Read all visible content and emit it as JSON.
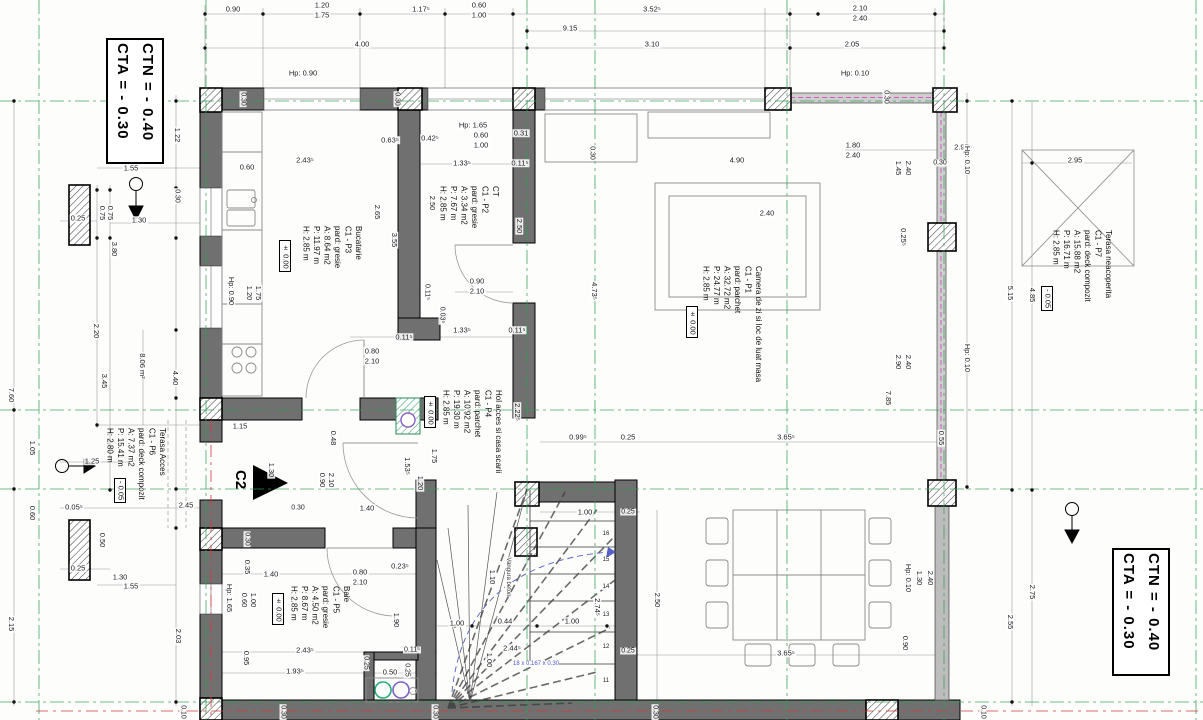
{
  "drawing": {
    "elevation_boxes": {
      "top_left": [
        "CTA = - 0.30",
        "CTN = - 0.40"
      ],
      "bottom_right": [
        "CTA = - 0.30",
        "CTN = - 0.40"
      ]
    },
    "section_marker": "C2",
    "stair_formula": "18 x 0.167 x 0.30",
    "stair_stringer_note": "Vangura beton",
    "colors": {
      "axis_green": "#2e9e52",
      "axis_red": "#d33a3a",
      "parapet_magenta": "#d957c8",
      "stair_blue": "#4a52c4",
      "sink_green": "#27ad7a",
      "sink_purple": "#7b61c9"
    },
    "rooms": [
      {
        "name": "Bucatarie",
        "code": "C1 - P3",
        "floor": "pard: gresie",
        "area": "A: 8.64 m2",
        "perimeter": "P: 11.97 m",
        "height": "H: 2.85 m",
        "level": "± 0.00"
      },
      {
        "name": "CT",
        "code": "C1 - P2",
        "floor": "pard: gresie",
        "area": "A: 3.34 m2",
        "perimeter": "P: 7.67 m",
        "height": "H: 2.85 m",
        "level": ""
      },
      {
        "name": "Camera de zi si loc de luat masa",
        "code": "C1 - P1",
        "floor": "pard: parchet",
        "area": "A: 32.72 m2",
        "perimeter": "P: 24.77 m",
        "height": "H: 2.85 m",
        "level": "± 0.00"
      },
      {
        "name": "Hol acces si casa scarii",
        "code": "C1 - P4",
        "floor": "pard: parchet",
        "area": "A: 10.92 m2",
        "perimeter": "P: 19.30 m",
        "height": "H: 2.85 m",
        "level": "± 0.00"
      },
      {
        "name": "Baie",
        "code": "C1 - P5",
        "floor": "pard: gresie",
        "area": "A: 4.50 m2",
        "perimeter": "P: 8.67 m",
        "height": "H: 2.85 m",
        "level": "± 0.00"
      },
      {
        "name": "Terasa Acces",
        "code": "C1 - P6",
        "floor": "pard: deck compozit",
        "area": "A: 7.37 m2",
        "perimeter": "P: 15.41 m",
        "height": "H: 2.80 m",
        "level": "- 0.05"
      },
      {
        "name": "Terasa neacoperita",
        "code": "C1 - P7",
        "floor": "pard: deck compozit",
        "area": "A: 15.88 m2",
        "perimeter": "P: 16.71 m",
        "height": "H: 2.85 m",
        "level": "- 0.05"
      }
    ],
    "dim_labels": [
      {
        "t": "0.90",
        "x": 233,
        "y": 9
      },
      {
        "t": "1.20",
        "x": 322,
        "y": 5
      },
      {
        "t": "1.75",
        "x": 322,
        "y": 15
      },
      {
        "t": "1.17⁵",
        "x": 421,
        "y": 9
      },
      {
        "t": "0.60",
        "x": 479,
        "y": 5
      },
      {
        "t": "1.00",
        "x": 479,
        "y": 15
      },
      {
        "t": "9.15",
        "x": 570,
        "y": 28
      },
      {
        "t": "3.52⁵",
        "x": 652,
        "y": 9
      },
      {
        "t": "2.10",
        "x": 860,
        "y": 8
      },
      {
        "t": "2.40",
        "x": 860,
        "y": 18
      },
      {
        "t": "4.00",
        "x": 362,
        "y": 44
      },
      {
        "t": "3.10",
        "x": 652,
        "y": 44
      },
      {
        "t": "2.05",
        "x": 852,
        "y": 44
      },
      {
        "t": "Hp: 0.90",
        "x": 303,
        "y": 73
      },
      {
        "t": "Hp: 0.10",
        "x": 855,
        "y": 73
      },
      {
        "t": "0.30",
        "x": 243,
        "y": 99,
        "v": 1,
        "s": 7
      },
      {
        "t": "0.30",
        "x": 397,
        "y": 99,
        "v": 1,
        "s": 7
      },
      {
        "t": "0.30",
        "x": 592,
        "y": 153,
        "v": 1,
        "s": 7
      },
      {
        "t": "0.30",
        "x": 886,
        "y": 97,
        "v": 1,
        "s": 7
      },
      {
        "t": "Hp: 1.65",
        "x": 473,
        "y": 125
      },
      {
        "t": "0.42⁵",
        "x": 430,
        "y": 138
      },
      {
        "t": "0.60",
        "x": 481,
        "y": 135
      },
      {
        "t": "1.00",
        "x": 481,
        "y": 145
      },
      {
        "t": "0.31",
        "x": 521,
        "y": 133
      },
      {
        "t": "1.33⁵",
        "x": 462,
        "y": 163
      },
      {
        "t": "0.11⁵",
        "x": 520,
        "y": 163
      },
      {
        "t": "2.43⁵",
        "x": 305,
        "y": 160
      },
      {
        "t": "0.63⁵",
        "x": 390,
        "y": 140
      },
      {
        "t": "0.60",
        "x": 247,
        "y": 167
      },
      {
        "t": "2.50",
        "x": 432,
        "y": 203,
        "v": 1
      },
      {
        "t": "2.50",
        "x": 519,
        "y": 226,
        "v": 1
      },
      {
        "t": "2.65",
        "x": 377,
        "y": 212,
        "v": 1
      },
      {
        "t": "3.55",
        "x": 394,
        "y": 240,
        "v": 1
      },
      {
        "t": "1.20",
        "x": 249,
        "y": 293,
        "v": 1
      },
      {
        "t": "1.75",
        "x": 258,
        "y": 293,
        "v": 1
      },
      {
        "t": "Hp: 0.90",
        "x": 231,
        "y": 291,
        "v": 1
      },
      {
        "t": "0.90",
        "x": 477,
        "y": 281
      },
      {
        "t": "2.10",
        "x": 477,
        "y": 291
      },
      {
        "t": "0.11⁵",
        "x": 427,
        "y": 292,
        "v": 1,
        "s": 7
      },
      {
        "t": "0.03⁵",
        "x": 442,
        "y": 315,
        "v": 1,
        "s": 7
      },
      {
        "t": "0.80",
        "x": 372,
        "y": 351
      },
      {
        "t": "2.10",
        "x": 372,
        "y": 361
      },
      {
        "t": "1.33⁵",
        "x": 462,
        "y": 330
      },
      {
        "t": "0.11⁵",
        "x": 517,
        "y": 330
      },
      {
        "t": "0.11⁵",
        "x": 404,
        "y": 337
      },
      {
        "t": "4.90",
        "x": 737,
        "y": 160
      },
      {
        "t": "2.40",
        "x": 767,
        "y": 213
      },
      {
        "t": "1.80",
        "x": 853,
        "y": 145
      },
      {
        "t": "2.40",
        "x": 853,
        "y": 155
      },
      {
        "t": "2.97⁵",
        "x": 963,
        "y": 147
      },
      {
        "t": "4.73⁵",
        "x": 594,
        "y": 291,
        "v": 1
      },
      {
        "t": "1.45",
        "x": 898,
        "y": 168,
        "v": 1
      },
      {
        "t": "2.40",
        "x": 908,
        "y": 168,
        "v": 1
      },
      {
        "t": "0.30",
        "x": 940,
        "y": 163,
        "s": 7
      },
      {
        "t": "Hp: 0.10",
        "x": 967,
        "y": 160,
        "v": 1
      },
      {
        "t": "0.25⁵",
        "x": 903,
        "y": 237,
        "v": 1
      },
      {
        "t": "2.90",
        "x": 898,
        "y": 362,
        "v": 1
      },
      {
        "t": "2.40",
        "x": 908,
        "y": 362,
        "v": 1
      },
      {
        "t": "Hp: 0.10",
        "x": 967,
        "y": 358,
        "v": 1
      },
      {
        "t": "5.15",
        "x": 1010,
        "y": 293,
        "v": 1
      },
      {
        "t": "7.85",
        "x": 888,
        "y": 398,
        "v": 1
      },
      {
        "t": "4.85",
        "x": 1032,
        "y": 295,
        "v": 1
      },
      {
        "t": "2.95",
        "x": 1075,
        "y": 160
      },
      {
        "t": "2.75",
        "x": 1032,
        "y": 592,
        "v": 1
      },
      {
        "t": "2.55",
        "x": 1010,
        "y": 622,
        "v": 1
      },
      {
        "t": "2.22⁵",
        "x": 517,
        "y": 412,
        "v": 1
      },
      {
        "t": "1.75",
        "x": 434,
        "y": 456,
        "v": 1
      },
      {
        "t": "1.20",
        "x": 420,
        "y": 483,
        "v": 1
      },
      {
        "t": "1.53⁵",
        "x": 407,
        "y": 466,
        "v": 1
      },
      {
        "t": "0.99⁵",
        "x": 578,
        "y": 437
      },
      {
        "t": "0.25",
        "x": 628,
        "y": 437
      },
      {
        "t": "3.65⁵",
        "x": 786,
        "y": 437
      },
      {
        "t": "0.55",
        "x": 941,
        "y": 438,
        "v": 1
      },
      {
        "t": "0.48",
        "x": 333,
        "y": 438,
        "v": 1
      },
      {
        "t": "0.90",
        "x": 322,
        "y": 480,
        "v": 1
      },
      {
        "t": "2.10",
        "x": 331,
        "y": 480,
        "v": 1
      },
      {
        "t": "1.30",
        "x": 271,
        "y": 470,
        "v": 1
      },
      {
        "t": "1.15",
        "x": 240,
        "y": 426
      },
      {
        "t": "2.45",
        "x": 186,
        "y": 505
      },
      {
        "t": "0.30",
        "x": 298,
        "y": 508,
        "s": 7
      },
      {
        "t": "1.40",
        "x": 367,
        "y": 508
      },
      {
        "t": "1.22",
        "x": 177,
        "y": 135,
        "v": 1
      },
      {
        "t": "1.55",
        "x": 131,
        "y": 168
      },
      {
        "t": "0.30",
        "x": 177,
        "y": 196,
        "v": 1,
        "s": 7
      },
      {
        "t": "0.75",
        "x": 102,
        "y": 213,
        "v": 1
      },
      {
        "t": "0.75",
        "x": 110,
        "y": 213,
        "v": 1
      },
      {
        "t": "1.30",
        "x": 139,
        "y": 220
      },
      {
        "t": "0.25",
        "x": 78,
        "y": 218
      },
      {
        "t": "3.80",
        "x": 114,
        "y": 249,
        "v": 1
      },
      {
        "t": "2.20",
        "x": 96,
        "y": 331,
        "v": 1
      },
      {
        "t": "3.45",
        "x": 104,
        "y": 381,
        "v": 1
      },
      {
        "t": "8.06 m²",
        "x": 142,
        "y": 366,
        "v": 1
      },
      {
        "t": "4.40",
        "x": 175,
        "y": 378,
        "v": 1
      },
      {
        "t": "7.60",
        "x": 11,
        "y": 395,
        "v": 1
      },
      {
        "t": "1.05",
        "x": 32,
        "y": 448,
        "v": 1
      },
      {
        "t": "1.25",
        "x": 92,
        "y": 461
      },
      {
        "t": "0.05⁵",
        "x": 74,
        "y": 507
      },
      {
        "t": "0.60",
        "x": 32,
        "y": 513,
        "v": 1
      },
      {
        "t": "0.50",
        "x": 102,
        "y": 540,
        "v": 1
      },
      {
        "t": "0.25",
        "x": 78,
        "y": 568
      },
      {
        "t": "1.30",
        "x": 120,
        "y": 577
      },
      {
        "t": "1.55",
        "x": 131,
        "y": 586
      },
      {
        "t": "2.15",
        "x": 11,
        "y": 624,
        "v": 1
      },
      {
        "t": "2.03",
        "x": 178,
        "y": 636,
        "v": 1
      },
      {
        "t": "0.35",
        "x": 247,
        "y": 567,
        "v": 1
      },
      {
        "t": "1.40",
        "x": 271,
        "y": 574
      },
      {
        "t": "0.23⁵",
        "x": 400,
        "y": 566
      },
      {
        "t": "0.80",
        "x": 360,
        "y": 572
      },
      {
        "t": "2.10",
        "x": 360,
        "y": 582
      },
      {
        "t": "Hp: 1.65",
        "x": 229,
        "y": 598,
        "v": 1
      },
      {
        "t": "0.60",
        "x": 244,
        "y": 600,
        "v": 1
      },
      {
        "t": "1.00",
        "x": 253,
        "y": 600,
        "v": 1
      },
      {
        "t": "1.90",
        "x": 278,
        "y": 618,
        "v": 1
      },
      {
        "t": "1.90",
        "x": 396,
        "y": 620,
        "v": 1
      },
      {
        "t": "0.95",
        "x": 246,
        "y": 658,
        "v": 1
      },
      {
        "t": "2.43⁵",
        "x": 305,
        "y": 650
      },
      {
        "t": "1.93⁵",
        "x": 295,
        "y": 671
      },
      {
        "t": "0.25",
        "x": 366,
        "y": 663,
        "v": 1,
        "s": 7
      },
      {
        "t": "0.50",
        "x": 390,
        "y": 672
      },
      {
        "t": "0.25",
        "x": 407,
        "y": 670,
        "v": 1,
        "s": 7
      },
      {
        "t": "0.11⁵",
        "x": 412,
        "y": 650,
        "s": 7
      },
      {
        "t": "0.30",
        "x": 247,
        "y": 539,
        "v": 1,
        "s": 7
      },
      {
        "t": "1.00",
        "x": 457,
        "y": 623
      },
      {
        "t": "0.44",
        "x": 505,
        "y": 621
      },
      {
        "t": "1.00",
        "x": 572,
        "y": 621
      },
      {
        "t": "2.44⁵",
        "x": 512,
        "y": 648
      },
      {
        "t": "1.10",
        "x": 492,
        "y": 577,
        "v": 1
      },
      {
        "t": "1.00",
        "x": 489,
        "y": 660,
        "v": 1
      },
      {
        "t": "2.74⁵",
        "x": 597,
        "y": 607,
        "v": 1
      },
      {
        "t": "2.50",
        "x": 657,
        "y": 600,
        "v": 1
      },
      {
        "t": "0.25",
        "x": 628,
        "y": 651,
        "s": 7
      },
      {
        "t": "0.25",
        "x": 628,
        "y": 512,
        "s": 7
      },
      {
        "t": "1.00",
        "x": 585,
        "y": 512
      },
      {
        "t": "16",
        "x": 606,
        "y": 534,
        "s": 6
      },
      {
        "t": "15",
        "x": 606,
        "y": 560,
        "s": 6
      },
      {
        "t": "14",
        "x": 606,
        "y": 587,
        "s": 6
      },
      {
        "t": "13",
        "x": 606,
        "y": 615,
        "s": 6
      },
      {
        "t": "12",
        "x": 606,
        "y": 647,
        "s": 6
      },
      {
        "t": "11",
        "x": 606,
        "y": 681,
        "s": 6
      },
      {
        "t": "Hp: 0.10",
        "x": 908,
        "y": 578,
        "v": 1
      },
      {
        "t": "1.30",
        "x": 919,
        "y": 578,
        "v": 1
      },
      {
        "t": "2.40",
        "x": 930,
        "y": 578,
        "v": 1
      },
      {
        "t": "0.90",
        "x": 905,
        "y": 643,
        "v": 1
      },
      {
        "t": "3.65⁵",
        "x": 786,
        "y": 653
      },
      {
        "t": "0.10",
        "x": 183,
        "y": 712,
        "v": 1,
        "s": 7
      },
      {
        "t": "0.30",
        "x": 283,
        "y": 712,
        "v": 1,
        "s": 7
      },
      {
        "t": "0.30",
        "x": 435,
        "y": 712,
        "v": 1,
        "s": 7
      },
      {
        "t": "0.30",
        "x": 655,
        "y": 712,
        "v": 1,
        "s": 7
      },
      {
        "t": "0.10",
        "x": 983,
        "y": 712,
        "v": 1,
        "s": 7
      }
    ]
  }
}
